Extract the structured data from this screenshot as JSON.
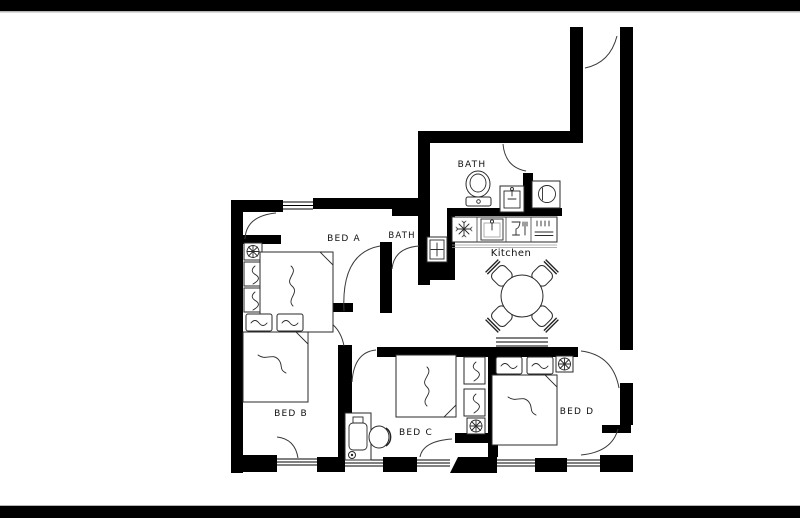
{
  "plan": {
    "type": "apartment-floor-plan",
    "rooms": {
      "bed_a": {
        "label": "BED A"
      },
      "bed_b": {
        "label": "BED B"
      },
      "bed_c": {
        "label": "BED C"
      },
      "bed_d": {
        "label": "BED D"
      },
      "bath_main": {
        "label": "BATH"
      },
      "bath_inner": {
        "label": "BATH"
      },
      "kitchen": {
        "label": "Kitchen"
      }
    },
    "furniture_icons": [
      "double-bed-icon",
      "pillow-icon",
      "nightstand-lamp-icon",
      "ceiling-light-icon",
      "toilet-icon",
      "washbasin-icon",
      "washing-machine-icon",
      "refrigerator-icon",
      "kitchen-sink-icon",
      "dishwasher-icon",
      "stove-icon",
      "dining-table-icon",
      "dining-chair-icon",
      "desk-icon",
      "desk-chair-icon",
      "door-arc",
      "window"
    ],
    "colors": {
      "wall": "#000000",
      "floor": "#ffffff",
      "letterbox": "#000000",
      "furniture_line": "#2a2a2a",
      "door_line": "#3a3a3a"
    }
  }
}
